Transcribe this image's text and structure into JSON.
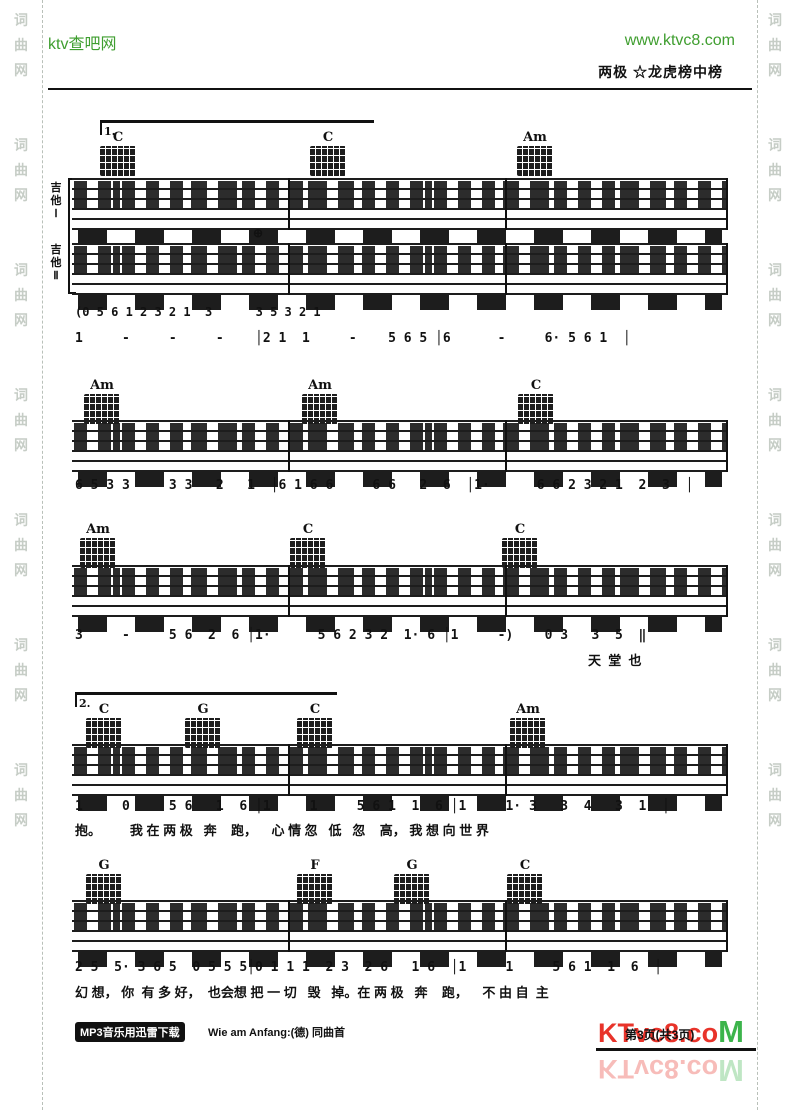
{
  "header": {
    "site_name": "ktv查吧网",
    "site_url": "www.ktvc8.com",
    "song_title": "两极 ☆龙虎榜中榜"
  },
  "watermark": {
    "column_text": "词\n曲\n网\n\n\n词\n曲\n网\n\n\n词\n曲\n网\n\n\n词\n曲\n网\n\n\n词\n曲\n网\n\n\n词\n曲\n网\n\n\n词\n曲\n网"
  },
  "systems": [
    {
      "volta": "1.",
      "guitar1_label": "吉\n他\nⅠ",
      "guitar2_label": "吉\n他\nⅡ",
      "annotation": "⊕",
      "chords": [
        {
          "label": "C"
        },
        {
          "label": "C"
        },
        {
          "label": "Am"
        }
      ],
      "jianpu_intro": "(0 5 6 1 2 3 2 1  3      3 5 3 2 1",
      "melody": "1     -     -     -    │2 1  1     -    5 6 5 │6      -     6· 5 6 1  │"
    },
    {
      "chords": [
        {
          "label": "Am"
        },
        {
          "label": "Am"
        },
        {
          "label": "C"
        }
      ],
      "melody": "6 5 3 3     3 3   2   1  │6 1 6 6     6 6   2  6  │1·      6 6 2 3 2 1  2  3  │"
    },
    {
      "chords": [
        {
          "label": "Am"
        },
        {
          "label": "C"
        },
        {
          "label": "C"
        }
      ],
      "melody": "3     -     5 6  2  6 │1·      5 6 2 3 2  1· 6 │1     -)    0 3   3  5  ‖",
      "lyrics": "天  堂  也"
    },
    {
      "volta": "2.",
      "chords": [
        {
          "label": "C"
        },
        {
          "label": "G"
        },
        {
          "label": "C"
        },
        {
          "label": "Am"
        }
      ],
      "melody": "1     0     5 6   1  6 │1     1     5 6 1  1  6 │1     1· 3   3  4   3  1  │",
      "lyrics": "抱。        我 在 两 极   奔    跑，    心 情 忽   低   忽    高， 我 想 向 世 界"
    },
    {
      "chords": [
        {
          "label": "G"
        },
        {
          "label": "F"
        },
        {
          "label": "G"
        },
        {
          "label": "C"
        }
      ],
      "melody": "2 5  5· 3 6 5  0 5 5 5│0 1 1 1  2 3  2 6   1 6  │1     1     5 6 1  1  6  │",
      "lyrics": "幻 想， 你  有 多 好，  也会想 把 一 切   毁   掉。在 两 极   奔    跑，    不 由 自  主"
    }
  ],
  "footer": {
    "download_tag": "MP3音乐用迅雷下载",
    "note": "Wie am Anfang:(德) 同曲首",
    "page_info": "第3页(共3页)",
    "logo_ktvc8": "KTvc8",
    "logo_dotco": ".co",
    "logo_m": "M"
  }
}
